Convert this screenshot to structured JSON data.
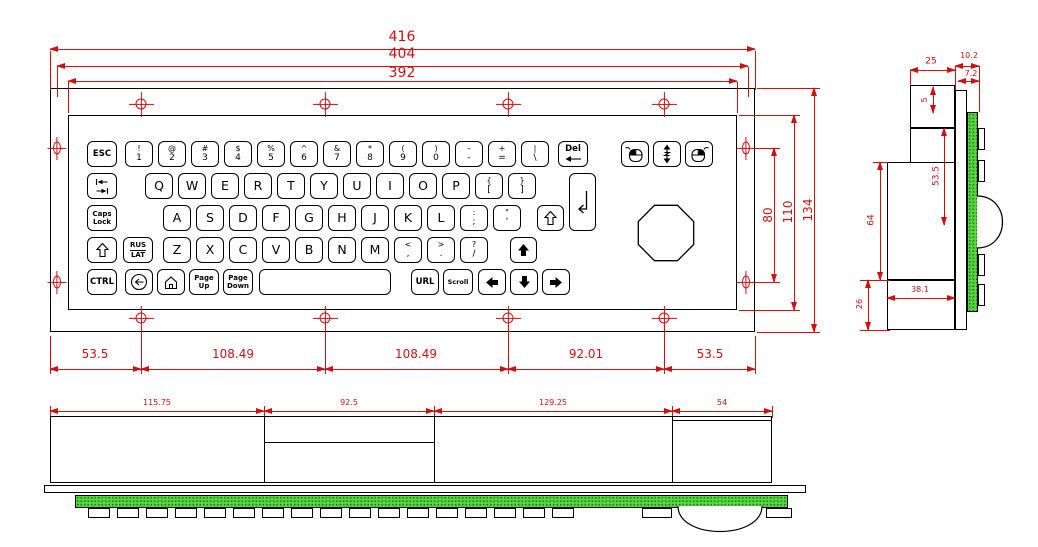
{
  "front_view": {
    "dims_top": [
      "416",
      "404",
      "392"
    ],
    "dims_bottom": [
      "53.5",
      "108.49",
      "108.49",
      "92.01",
      "53.5"
    ],
    "dims_right": [
      "80",
      "110",
      "134"
    ],
    "keyboard": {
      "rows": [
        {
          "y": 25,
          "keys": [
            {
              "x": 18,
              "w": 30,
              "label": "ESC",
              "cls": "cmd",
              "name": "key-esc"
            },
            {
              "x": 56,
              "top": "!",
              "bottom": "1",
              "name": "key-1"
            },
            {
              "x": 89,
              "top": "@",
              "bottom": "2",
              "name": "key-2"
            },
            {
              "x": 122,
              "top": "#",
              "bottom": "3",
              "name": "key-3"
            },
            {
              "x": 155,
              "top": "$",
              "bottom": "4",
              "name": "key-4"
            },
            {
              "x": 188,
              "top": "%",
              "bottom": "5",
              "name": "key-5"
            },
            {
              "x": 221,
              "top": "^",
              "bottom": "6",
              "name": "key-6"
            },
            {
              "x": 254,
              "top": "&",
              "bottom": "7",
              "name": "key-7"
            },
            {
              "x": 287,
              "top": "*",
              "bottom": "8",
              "name": "key-8"
            },
            {
              "x": 320,
              "top": "(",
              "bottom": "9",
              "name": "key-9"
            },
            {
              "x": 353,
              "top": ")",
              "bottom": "0",
              "name": "key-0"
            },
            {
              "x": 386,
              "top": "–",
              "bottom": "-",
              "name": "key-minus"
            },
            {
              "x": 419,
              "top": "+",
              "bottom": "=",
              "name": "key-equals"
            },
            {
              "x": 452,
              "top": "|",
              "bottom": "\\",
              "name": "key-backslash"
            },
            {
              "x": 489,
              "w": 30,
              "top": "Del",
              "icon": "backspace-arrow-icon",
              "cls": "cmd",
              "name": "key-del"
            },
            {
              "x": 552,
              "icon": "mouse-left-click-icon",
              "name": "key-mouse-left-button"
            },
            {
              "x": 584,
              "icon": "mouse-scroll-icon",
              "name": "key-mouse-scroll"
            },
            {
              "x": 616,
              "icon": "mouse-right-click-icon",
              "name": "key-mouse-right-button"
            }
          ]
        },
        {
          "y": 57,
          "keys": [
            {
              "x": 18,
              "w": 30,
              "icon": "tab-icon",
              "name": "key-tab"
            },
            {
              "x": 76,
              "label": "Q",
              "name": "key-q"
            },
            {
              "x": 109,
              "label": "W",
              "name": "key-w"
            },
            {
              "x": 142,
              "label": "E",
              "name": "key-e"
            },
            {
              "x": 175,
              "label": "R",
              "name": "key-r"
            },
            {
              "x": 208,
              "label": "T",
              "name": "key-t"
            },
            {
              "x": 241,
              "label": "Y",
              "name": "key-y"
            },
            {
              "x": 274,
              "label": "U",
              "name": "key-u"
            },
            {
              "x": 307,
              "label": "I",
              "name": "key-i"
            },
            {
              "x": 340,
              "label": "O",
              "name": "key-o"
            },
            {
              "x": 373,
              "label": "P",
              "name": "key-p"
            },
            {
              "x": 406,
              "top": "{",
              "bottom": "[",
              "name": "key-open-bracket"
            },
            {
              "x": 439,
              "top": "}",
              "bottom": "]",
              "name": "key-close-bracket"
            },
            {
              "x": 500,
              "w": 27,
              "h": 58,
              "icon": "enter-icon",
              "name": "key-enter"
            }
          ]
        },
        {
          "y": 89,
          "keys": [
            {
              "x": 18,
              "w": 30,
              "top": "Caps",
              "bottom": "Lock",
              "cls": "cmd2",
              "name": "key-caps-lock"
            },
            {
              "x": 94,
              "label": "A",
              "name": "key-a"
            },
            {
              "x": 127,
              "label": "S",
              "name": "key-s"
            },
            {
              "x": 160,
              "label": "D",
              "name": "key-d"
            },
            {
              "x": 193,
              "label": "F",
              "name": "key-f"
            },
            {
              "x": 226,
              "label": "G",
              "name": "key-g"
            },
            {
              "x": 259,
              "label": "H",
              "name": "key-h"
            },
            {
              "x": 292,
              "label": "J",
              "name": "key-j"
            },
            {
              "x": 325,
              "label": "K",
              "name": "key-k"
            },
            {
              "x": 358,
              "label": "L",
              "name": "key-l"
            },
            {
              "x": 391,
              "top": ":",
              "bottom": ";",
              "name": "key-semicolon"
            },
            {
              "x": 424,
              "top": "\"",
              "bottom": "'",
              "name": "key-quote"
            },
            {
              "x": 468,
              "w": 27,
              "icon": "shift-outline-icon",
              "name": "key-shift-right"
            }
          ]
        },
        {
          "y": 121,
          "keys": [
            {
              "x": 18,
              "w": 30,
              "icon": "shift-outline-icon",
              "name": "key-shift-left"
            },
            {
              "x": 54,
              "w": 30,
              "top": "RUS",
              "bottom": "LAT",
              "divider": true,
              "cls": "cmd2",
              "name": "key-rus-lat"
            },
            {
              "x": 94,
              "label": "Z",
              "name": "key-z"
            },
            {
              "x": 127,
              "label": "X",
              "name": "key-x"
            },
            {
              "x": 160,
              "label": "C",
              "name": "key-c"
            },
            {
              "x": 193,
              "label": "V",
              "name": "key-v"
            },
            {
              "x": 226,
              "label": "B",
              "name": "key-b"
            },
            {
              "x": 259,
              "label": "N",
              "name": "key-n"
            },
            {
              "x": 292,
              "label": "M",
              "name": "key-m"
            },
            {
              "x": 325,
              "top": "<",
              "bottom": ",",
              "name": "key-comma"
            },
            {
              "x": 358,
              "top": ">",
              "bottom": ".",
              "name": "key-period"
            },
            {
              "x": 391,
              "top": "?",
              "bottom": "/",
              "name": "key-slash"
            },
            {
              "x": 441,
              "w": 27,
              "icon": "arrow-up-icon",
              "name": "key-arrow-up"
            }
          ]
        },
        {
          "y": 153,
          "keys": [
            {
              "x": 18,
              "w": 30,
              "label": "CTRL",
              "cls": "cmd",
              "name": "key-ctrl"
            },
            {
              "x": 56,
              "icon": "backspace-circle-icon",
              "name": "key-backspace"
            },
            {
              "x": 88,
              "icon": "home-icon",
              "name": "key-home"
            },
            {
              "x": 120,
              "w": 30,
              "top": "Page",
              "bottom": "Up",
              "cls": "cmd2",
              "name": "key-page-up"
            },
            {
              "x": 154,
              "w": 30,
              "top": "Page",
              "bottom": "Down",
              "cls": "cmd2",
              "name": "key-page-down"
            },
            {
              "x": 190,
              "w": 132,
              "label": "",
              "name": "key-space"
            },
            {
              "x": 342,
              "label": "URL",
              "cls": "cmd",
              "name": "key-url"
            },
            {
              "x": 374,
              "w": 30,
              "label": "Scroll",
              "cls": "cmd3",
              "name": "key-scroll"
            },
            {
              "x": 409,
              "icon": "arrow-left-icon",
              "name": "key-arrow-left"
            },
            {
              "x": 441,
              "icon": "arrow-down-icon",
              "name": "key-arrow-down"
            },
            {
              "x": 473,
              "icon": "arrow-right-icon",
              "name": "key-arrow-right"
            }
          ]
        }
      ]
    }
  },
  "side_view": {
    "dims": {
      "top_width": "25",
      "flange_depth": "10.2",
      "panel_depth": "7.2",
      "inset": "5",
      "upper_height": "53.5",
      "body_height": "64",
      "bottom_width": "38.1",
      "bottom_height": "26"
    }
  },
  "bottom_view": {
    "dims": [
      "115.75",
      "92.5",
      "129.25",
      "54"
    ]
  }
}
